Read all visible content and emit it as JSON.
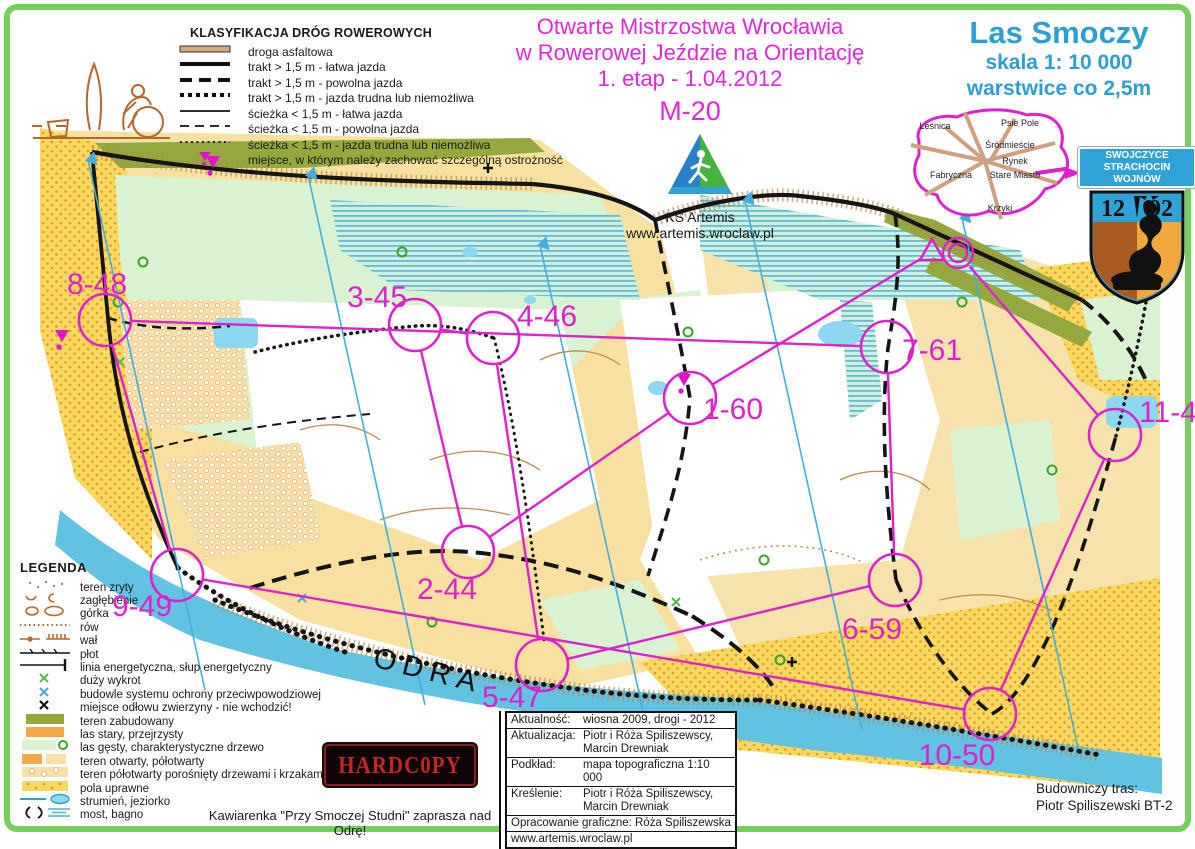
{
  "colors": {
    "course_magenta": "#dd22cc",
    "title_magenta": "#e028d8",
    "map_title_blue": "#2b9fd4",
    "frame_green": "#74d05c",
    "builtup_olive": "#94a83e",
    "open_yellow": "#f8e0a0",
    "field_yellow": "#f8d95e",
    "forest_green": "#d9f2d2",
    "river_blue": "#62c2e2"
  },
  "event": {
    "title_line1": "Otwarte Mistrzostwa Wrocławia",
    "title_line2": "w Rowerowej Jeździe na Orientację",
    "title_line3": "1. etap - 1.04.2012",
    "category": "M-20"
  },
  "map_title": {
    "name": "Las Smoczy",
    "scale": "skala 1: 10 000",
    "contours": "warstwice co 2,5m"
  },
  "club": {
    "name": "KS Artemis",
    "website": "www.artemis.wroclaw.pl"
  },
  "road_classification": {
    "heading": "KLASYFIKACJA DRÓG ROWEROWYCH",
    "items": [
      {
        "symbol": "asphalt-road",
        "label": "droga asfaltowa"
      },
      {
        "symbol": "track-easy",
        "label": "trakt > 1,5 m - łatwa jazda"
      },
      {
        "symbol": "track-slow",
        "label": "trakt > 1,5 m - powolna jazda"
      },
      {
        "symbol": "track-hard",
        "label": "trakt > 1,5 m - jazda trudna lub niemożliwa"
      },
      {
        "symbol": "path-easy",
        "label": "ścieżka < 1,5 m - łatwa jazda"
      },
      {
        "symbol": "path-slow",
        "label": "ścieżka < 1,5 m - powolna jazda"
      },
      {
        "symbol": "path-hard",
        "label": "ścieżka < 1,5 m - jazda trudna lub niemożliwa"
      },
      {
        "symbol": "caution",
        "label": "miejsce, w którym należy zachować szczególną ostrożność"
      }
    ]
  },
  "legend": {
    "heading": "LEGENDA",
    "items": [
      {
        "symbol": "rough-ground",
        "label": "teren zryty"
      },
      {
        "symbol": "depression",
        "label": "zagłębienie"
      },
      {
        "symbol": "knoll",
        "label": "górka"
      },
      {
        "symbol": "ditch",
        "label": "rów"
      },
      {
        "symbol": "embankment",
        "label": "wał"
      },
      {
        "symbol": "fence",
        "label": "płot"
      },
      {
        "symbol": "power-line",
        "label": "linia energetyczna, słup energetyczny"
      },
      {
        "symbol": "rootstock",
        "label": "duży wykrot"
      },
      {
        "symbol": "flood-structure",
        "label": "budowle systemu ochrony przeciwpowodziowej"
      },
      {
        "symbol": "no-entry",
        "label": "miejsce odłowu zwierzyny - nie wchodzić!"
      },
      {
        "symbol": "built-up",
        "label": "teren zabudowany"
      },
      {
        "symbol": "old-forest",
        "label": "las stary, przejrzysty"
      },
      {
        "symbol": "dense-forest",
        "label": "las gęsty, charakterystyczne drzewo"
      },
      {
        "symbol": "open-land",
        "label": "teren otwarty, półotwarty"
      },
      {
        "symbol": "semi-open-bushes",
        "label": "teren półotwarty porośnięty drzewami i krzakami"
      },
      {
        "symbol": "cultivated",
        "label": "pola uprawne"
      },
      {
        "symbol": "stream-lake",
        "label": "strumień, jeziorko"
      },
      {
        "symbol": "bridge-marsh",
        "label": "most, bagno"
      }
    ]
  },
  "city_inset": {
    "districts": [
      {
        "name": "Leśnica",
        "x": 30,
        "y": 23
      },
      {
        "name": "Psie Pole",
        "x": 115,
        "y": 20
      },
      {
        "name": "Śródmieście",
        "x": 105,
        "y": 42
      },
      {
        "name": "Rynek",
        "x": 110,
        "y": 58
      },
      {
        "name": "Fabryczna",
        "x": 46,
        "y": 72
      },
      {
        "name": "Stare Miasto",
        "x": 110,
        "y": 72
      },
      {
        "name": "Krzyki",
        "x": 95,
        "y": 105
      }
    ]
  },
  "district_sign": {
    "line1": "SWOJCZYCE",
    "line2": "STRACHOCIN WOJNÓW"
  },
  "coat_of_arms": {
    "year_left": "12",
    "year_right": "92"
  },
  "river_label": "ODRA",
  "course": {
    "circle_radius": 26,
    "start": {
      "x": 932,
      "y": 252
    },
    "finish": {
      "x": 958,
      "y": 253
    },
    "controls": [
      {
        "label": "1-60",
        "cx": 690,
        "cy": 398,
        "lx": 733,
        "ly": 410
      },
      {
        "label": "2-44",
        "cx": 468,
        "cy": 552,
        "lx": 447,
        "ly": 590
      },
      {
        "label": "3-45",
        "cx": 415,
        "cy": 325,
        "lx": 377,
        "ly": 298
      },
      {
        "label": "4-46",
        "cx": 493,
        "cy": 338,
        "lx": 547,
        "ly": 317
      },
      {
        "label": "5-47",
        "cx": 542,
        "cy": 665,
        "lx": 512,
        "ly": 698
      },
      {
        "label": "6-59",
        "cx": 895,
        "cy": 580,
        "lx": 872,
        "ly": 630
      },
      {
        "label": "7-61",
        "cx": 887,
        "cy": 347,
        "lx": 932,
        "ly": 351
      },
      {
        "label": "8-48",
        "cx": 105,
        "cy": 320,
        "lx": 97,
        "ly": 285
      },
      {
        "label": "9-49",
        "cx": 177,
        "cy": 575,
        "lx": 142,
        "ly": 607
      },
      {
        "label": "10-50",
        "cx": 990,
        "cy": 714,
        "lx": 957,
        "ly": 756
      },
      {
        "label": "11-4",
        "cx": 1115,
        "cy": 435,
        "lx": 1168,
        "ly": 413
      }
    ]
  },
  "info_box": {
    "rows": [
      {
        "label": "Aktualność:",
        "value": "wiosna 2009, drogi - 2012"
      },
      {
        "label": "Aktualizacja:",
        "value": "Piotr i Róża Spiliszewscy,\nMarcin Drewniak"
      },
      {
        "label": "Podkład:",
        "value": "mapa topograficzna 1:10 000"
      },
      {
        "label": "Kreślenie:",
        "value": "Piotr i Róża Spiliszewscy,\nMarcin Drewniak"
      },
      {
        "label": "",
        "value": "Opracowanie graficzne: Róża Spiliszewska",
        "single": true
      },
      {
        "label": "",
        "value": "www.artemis.wroclaw.pl",
        "single": true
      }
    ]
  },
  "hardcopy_logo": "HARDC0PY",
  "cafe_note": "Kawiarenka \"Przy Smoczej Studni\" zaprasza nad Odrę!",
  "course_builder": {
    "line1": "Budowniczy tras:",
    "line2": "Piotr Spiliszewski BT-2"
  }
}
